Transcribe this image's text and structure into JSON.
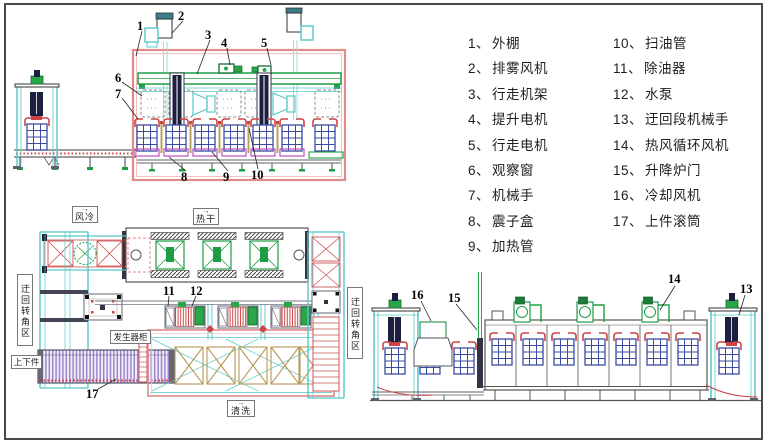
{
  "legend": {
    "col1": [
      {
        "num": "1、",
        "label": "外棚"
      },
      {
        "num": "2、",
        "label": "排雾风机"
      },
      {
        "num": "3、",
        "label": "行走机架"
      },
      {
        "num": "4、",
        "label": "提升电机"
      },
      {
        "num": "5、",
        "label": "行走电机"
      },
      {
        "num": "6、",
        "label": "观察窗"
      },
      {
        "num": "7、",
        "label": "机械手"
      },
      {
        "num": "8、",
        "label": "震子盒"
      },
      {
        "num": "9、",
        "label": "加热管"
      }
    ],
    "col2": [
      {
        "num": "10、",
        "label": "扫油管"
      },
      {
        "num": "11、",
        "label": "除油器"
      },
      {
        "num": "12、",
        "label": "水泵"
      },
      {
        "num": "13、",
        "label": "迂回段机械手"
      },
      {
        "num": "14、",
        "label": "热风循环风机"
      },
      {
        "num": "15、",
        "label": "升降炉门"
      },
      {
        "num": "16、",
        "label": "冷却风机"
      },
      {
        "num": "17、",
        "label": "上件滚筒"
      }
    ]
  },
  "plan_labels": {
    "air_cooling": "风冷",
    "hot_drying": "热干",
    "cleaning": "清洗",
    "generator_cabinet": "发生器柜",
    "load_unload": "上下件",
    "detour_corner_left": "迂回转角区",
    "detour_corner_right": "迂回转角区",
    "flow_arrow": "→"
  },
  "callouts": {
    "c1": "1",
    "c2": "2",
    "c3": "3",
    "c4": "4",
    "c5": "5",
    "c6": "6",
    "c7": "7",
    "c8": "8",
    "c9": "9",
    "c10": "10",
    "c11": "11",
    "c12": "12",
    "c13": "13",
    "c14": "14",
    "c15": "15",
    "c16": "16",
    "c17": "17"
  },
  "colors": {
    "shed_red": "#e08a8a",
    "strong_red": "#cc4444",
    "rail_green": "#1f9d44",
    "frame_cyan": "#56c8c8",
    "basket_blue": "#3c4ba0",
    "vibration_pink": "#c050c0",
    "tank_tan": "#b89858",
    "roller_purple": "#9c86c8",
    "structure_gray": "#606068"
  }
}
